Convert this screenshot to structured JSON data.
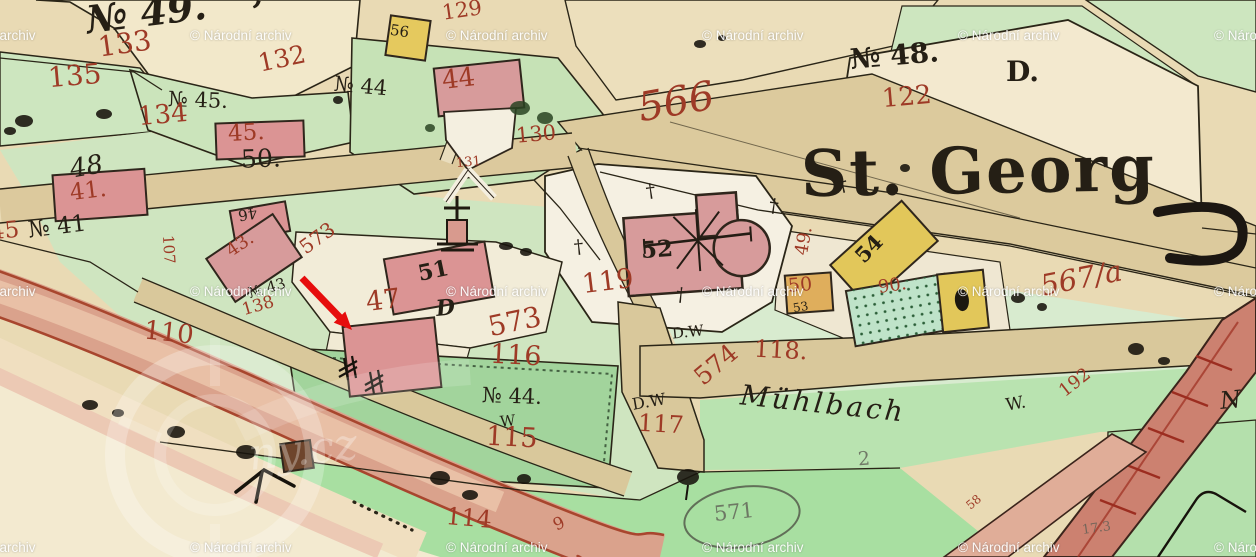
{
  "map": {
    "labels": [
      {
        "t": "№ 49.",
        "x": 86,
        "y": -6,
        "s": 38,
        "r": -7,
        "c": "ink",
        "i": 1,
        "b": 1
      },
      {
        "t": "’",
        "x": 250,
        "y": -2,
        "s": 30,
        "r": 12,
        "c": "ink",
        "b": 1
      },
      {
        "t": "№ 45.",
        "x": 168,
        "y": 90,
        "s": 21,
        "r": 2,
        "c": "ink"
      },
      {
        "t": "50.",
        "x": 241,
        "y": 146,
        "s": 25,
        "r": -2,
        "c": "ink"
      },
      {
        "t": "№ 44",
        "x": 334,
        "y": 76,
        "s": 21,
        "r": 5,
        "c": "ink"
      },
      {
        "t": "№ 41",
        "x": 28,
        "y": 216,
        "s": 23,
        "r": -7,
        "c": "ink"
      },
      {
        "t": "48",
        "x": 70,
        "y": 154,
        "s": 26,
        "r": -10,
        "c": "ink",
        "i": 1
      },
      {
        "t": "№ 48.",
        "x": 850,
        "y": 42,
        "s": 28,
        "r": -5,
        "c": "ink",
        "b": 1
      },
      {
        "t": "D.",
        "x": 1006,
        "y": 58,
        "s": 28,
        "r": 0,
        "c": "ink",
        "b": 1
      },
      {
        "t": "St. Georg",
        "x": 801,
        "y": 140,
        "s": 64,
        "r": -1,
        "c": "ink",
        "b": 1,
        "ls": 2
      },
      {
        "t": "52",
        "x": 641,
        "y": 238,
        "s": 23,
        "r": -4,
        "c": "ink",
        "b": 1
      },
      {
        "t": "51",
        "x": 418,
        "y": 260,
        "s": 22,
        "r": -12,
        "c": "ink",
        "b": 1
      },
      {
        "t": "46",
        "x": 238,
        "y": 206,
        "s": 15,
        "r": 170,
        "c": "ink"
      },
      {
        "t": "№ 43",
        "x": 248,
        "y": 281,
        "s": 15,
        "r": -16,
        "c": "ink"
      },
      {
        "t": "№ 44.",
        "x": 482,
        "y": 386,
        "s": 21,
        "r": 2,
        "c": "ink"
      },
      {
        "t": "W",
        "x": 500,
        "y": 414,
        "s": 15,
        "r": -6,
        "c": "ink"
      },
      {
        "t": "D.W",
        "x": 672,
        "y": 325,
        "s": 15,
        "r": -6,
        "c": "ink"
      },
      {
        "t": "D.W",
        "x": 632,
        "y": 394,
        "s": 16,
        "r": -10,
        "c": "ink"
      },
      {
        "t": "Mühlbach",
        "x": 740,
        "y": 390,
        "s": 28,
        "r": 6,
        "c": "ink",
        "i": 1,
        "ls": 3
      },
      {
        "t": "W.",
        "x": 1006,
        "y": 396,
        "s": 17,
        "r": -10,
        "c": "ink"
      },
      {
        "t": "54",
        "x": 854,
        "y": 238,
        "s": 21,
        "r": -46,
        "c": "ink",
        "b": 1
      },
      {
        "t": "53",
        "x": 793,
        "y": 301,
        "s": 12,
        "r": -10,
        "c": "ink"
      },
      {
        "t": "56",
        "x": 390,
        "y": 24,
        "s": 15,
        "r": 8,
        "c": "ink"
      },
      {
        "t": "N",
        "x": 1220,
        "y": 388,
        "s": 24,
        "r": -6,
        "c": "ink",
        "i": 1
      },
      {
        "t": "D",
        "x": 436,
        "y": 297,
        "s": 22,
        "r": -6,
        "c": "ink",
        "i": 1,
        "b": 1
      },
      {
        "t": "†",
        "x": 646,
        "y": 182,
        "s": 19,
        "r": -8,
        "c": "ink"
      },
      {
        "t": "†",
        "x": 769,
        "y": 197,
        "s": 19,
        "r": 8,
        "c": "ink"
      },
      {
        "t": "†",
        "x": 574,
        "y": 238,
        "s": 19,
        "r": -6,
        "c": "ink"
      },
      {
        "t": "†",
        "x": 676,
        "y": 286,
        "s": 19,
        "r": 6,
        "c": "ink"
      },
      {
        "t": "†",
        "x": 838,
        "y": 176,
        "s": 19,
        "r": -12,
        "c": "ink"
      },
      {
        "t": "571",
        "x": 714,
        "y": 502,
        "s": 21,
        "r": -6,
        "c": "pencil"
      },
      {
        "t": "2",
        "x": 858,
        "y": 450,
        "s": 19,
        "r": -4,
        "c": "pencil"
      },
      {
        "t": "17.3",
        "x": 1082,
        "y": 522,
        "s": 13,
        "r": -8,
        "c": "pencil"
      },
      {
        "t": "133",
        "x": 98,
        "y": 30,
        "s": 28,
        "r": -8,
        "c": "red"
      },
      {
        "t": "135",
        "x": 48,
        "y": 62,
        "s": 28,
        "r": -5,
        "c": "red"
      },
      {
        "t": "134",
        "x": 138,
        "y": 102,
        "s": 26,
        "r": -5,
        "c": "red"
      },
      {
        "t": "132",
        "x": 258,
        "y": 46,
        "s": 25,
        "r": -12,
        "c": "red"
      },
      {
        "t": "45.",
        "x": 228,
        "y": 122,
        "s": 23,
        "r": -3,
        "c": "red"
      },
      {
        "t": "41.",
        "x": 70,
        "y": 180,
        "s": 23,
        "r": -7,
        "c": "red"
      },
      {
        "t": "44",
        "x": 442,
        "y": 66,
        "s": 26,
        "r": -7,
        "c": "red"
      },
      {
        "t": "129",
        "x": 442,
        "y": 0,
        "s": 21,
        "r": -8,
        "c": "red"
      },
      {
        "t": "130",
        "x": 516,
        "y": 124,
        "s": 21,
        "r": -5,
        "c": "red"
      },
      {
        "t": "131",
        "x": 456,
        "y": 156,
        "s": 13,
        "r": -5,
        "c": "red"
      },
      {
        "t": "566",
        "x": 638,
        "y": 82,
        "s": 40,
        "r": -10,
        "c": "red",
        "i": 1
      },
      {
        "t": "122",
        "x": 882,
        "y": 84,
        "s": 26,
        "r": -5,
        "c": "red"
      },
      {
        "t": "119",
        "x": 582,
        "y": 268,
        "s": 27,
        "r": -7,
        "c": "red"
      },
      {
        "t": "567/a",
        "x": 1040,
        "y": 264,
        "s": 29,
        "r": -11,
        "c": "red",
        "i": 1
      },
      {
        "t": "573",
        "x": 298,
        "y": 228,
        "s": 20,
        "r": -36,
        "c": "red"
      },
      {
        "t": "573",
        "x": 488,
        "y": 308,
        "s": 28,
        "r": -12,
        "c": "red"
      },
      {
        "t": "574",
        "x": 692,
        "y": 352,
        "s": 25,
        "r": -40,
        "c": "red"
      },
      {
        "t": "116",
        "x": 490,
        "y": 342,
        "s": 27,
        "r": 3,
        "c": "red"
      },
      {
        "t": "115",
        "x": 486,
        "y": 424,
        "s": 27,
        "r": 3,
        "c": "red"
      },
      {
        "t": "114",
        "x": 446,
        "y": 506,
        "s": 24,
        "r": 5,
        "c": "red"
      },
      {
        "t": "117",
        "x": 638,
        "y": 412,
        "s": 24,
        "r": 3,
        "c": "red"
      },
      {
        "t": "118.",
        "x": 754,
        "y": 338,
        "s": 24,
        "r": 3,
        "c": "red"
      },
      {
        "t": "110",
        "x": 144,
        "y": 320,
        "s": 26,
        "r": 6,
        "c": "red"
      },
      {
        "t": "47",
        "x": 366,
        "y": 287,
        "s": 27,
        "r": -7,
        "c": "red"
      },
      {
        "t": "43.",
        "x": 226,
        "y": 236,
        "s": 18,
        "r": -34,
        "c": "red"
      },
      {
        "t": "138",
        "x": 242,
        "y": 298,
        "s": 17,
        "r": -16,
        "c": "red"
      },
      {
        "t": "107",
        "x": 154,
        "y": 242,
        "s": 15,
        "r": 86,
        "c": "red"
      },
      {
        "t": "49.",
        "x": 790,
        "y": 232,
        "s": 18,
        "r": -80,
        "c": "red"
      },
      {
        "t": "50",
        "x": 788,
        "y": 276,
        "s": 19,
        "r": -5,
        "c": "red"
      },
      {
        "t": "90.",
        "x": 878,
        "y": 277,
        "s": 18,
        "r": -8,
        "c": "red"
      },
      {
        "t": "192",
        "x": 1058,
        "y": 374,
        "s": 18,
        "r": -38,
        "c": "red"
      },
      {
        "t": "58",
        "x": 966,
        "y": 496,
        "s": 12,
        "r": -40,
        "c": "red"
      },
      {
        "t": "45",
        "x": -10,
        "y": 220,
        "s": 23,
        "r": -5,
        "c": "red"
      },
      {
        "t": "9",
        "x": 554,
        "y": 516,
        "s": 17,
        "r": -26,
        "c": "red"
      }
    ]
  },
  "watermark": {
    "text": "© Národní archiv",
    "rows": [
      28,
      284,
      540
    ],
    "cols": [
      -66,
      190,
      446,
      702,
      958,
      1214
    ]
  },
  "ghost_watermark": {
    "text": "ny.cz"
  },
  "annotation_arrow": {
    "color": "#e60d0d",
    "from": [
      302,
      278
    ],
    "to": [
      352,
      330
    ]
  }
}
